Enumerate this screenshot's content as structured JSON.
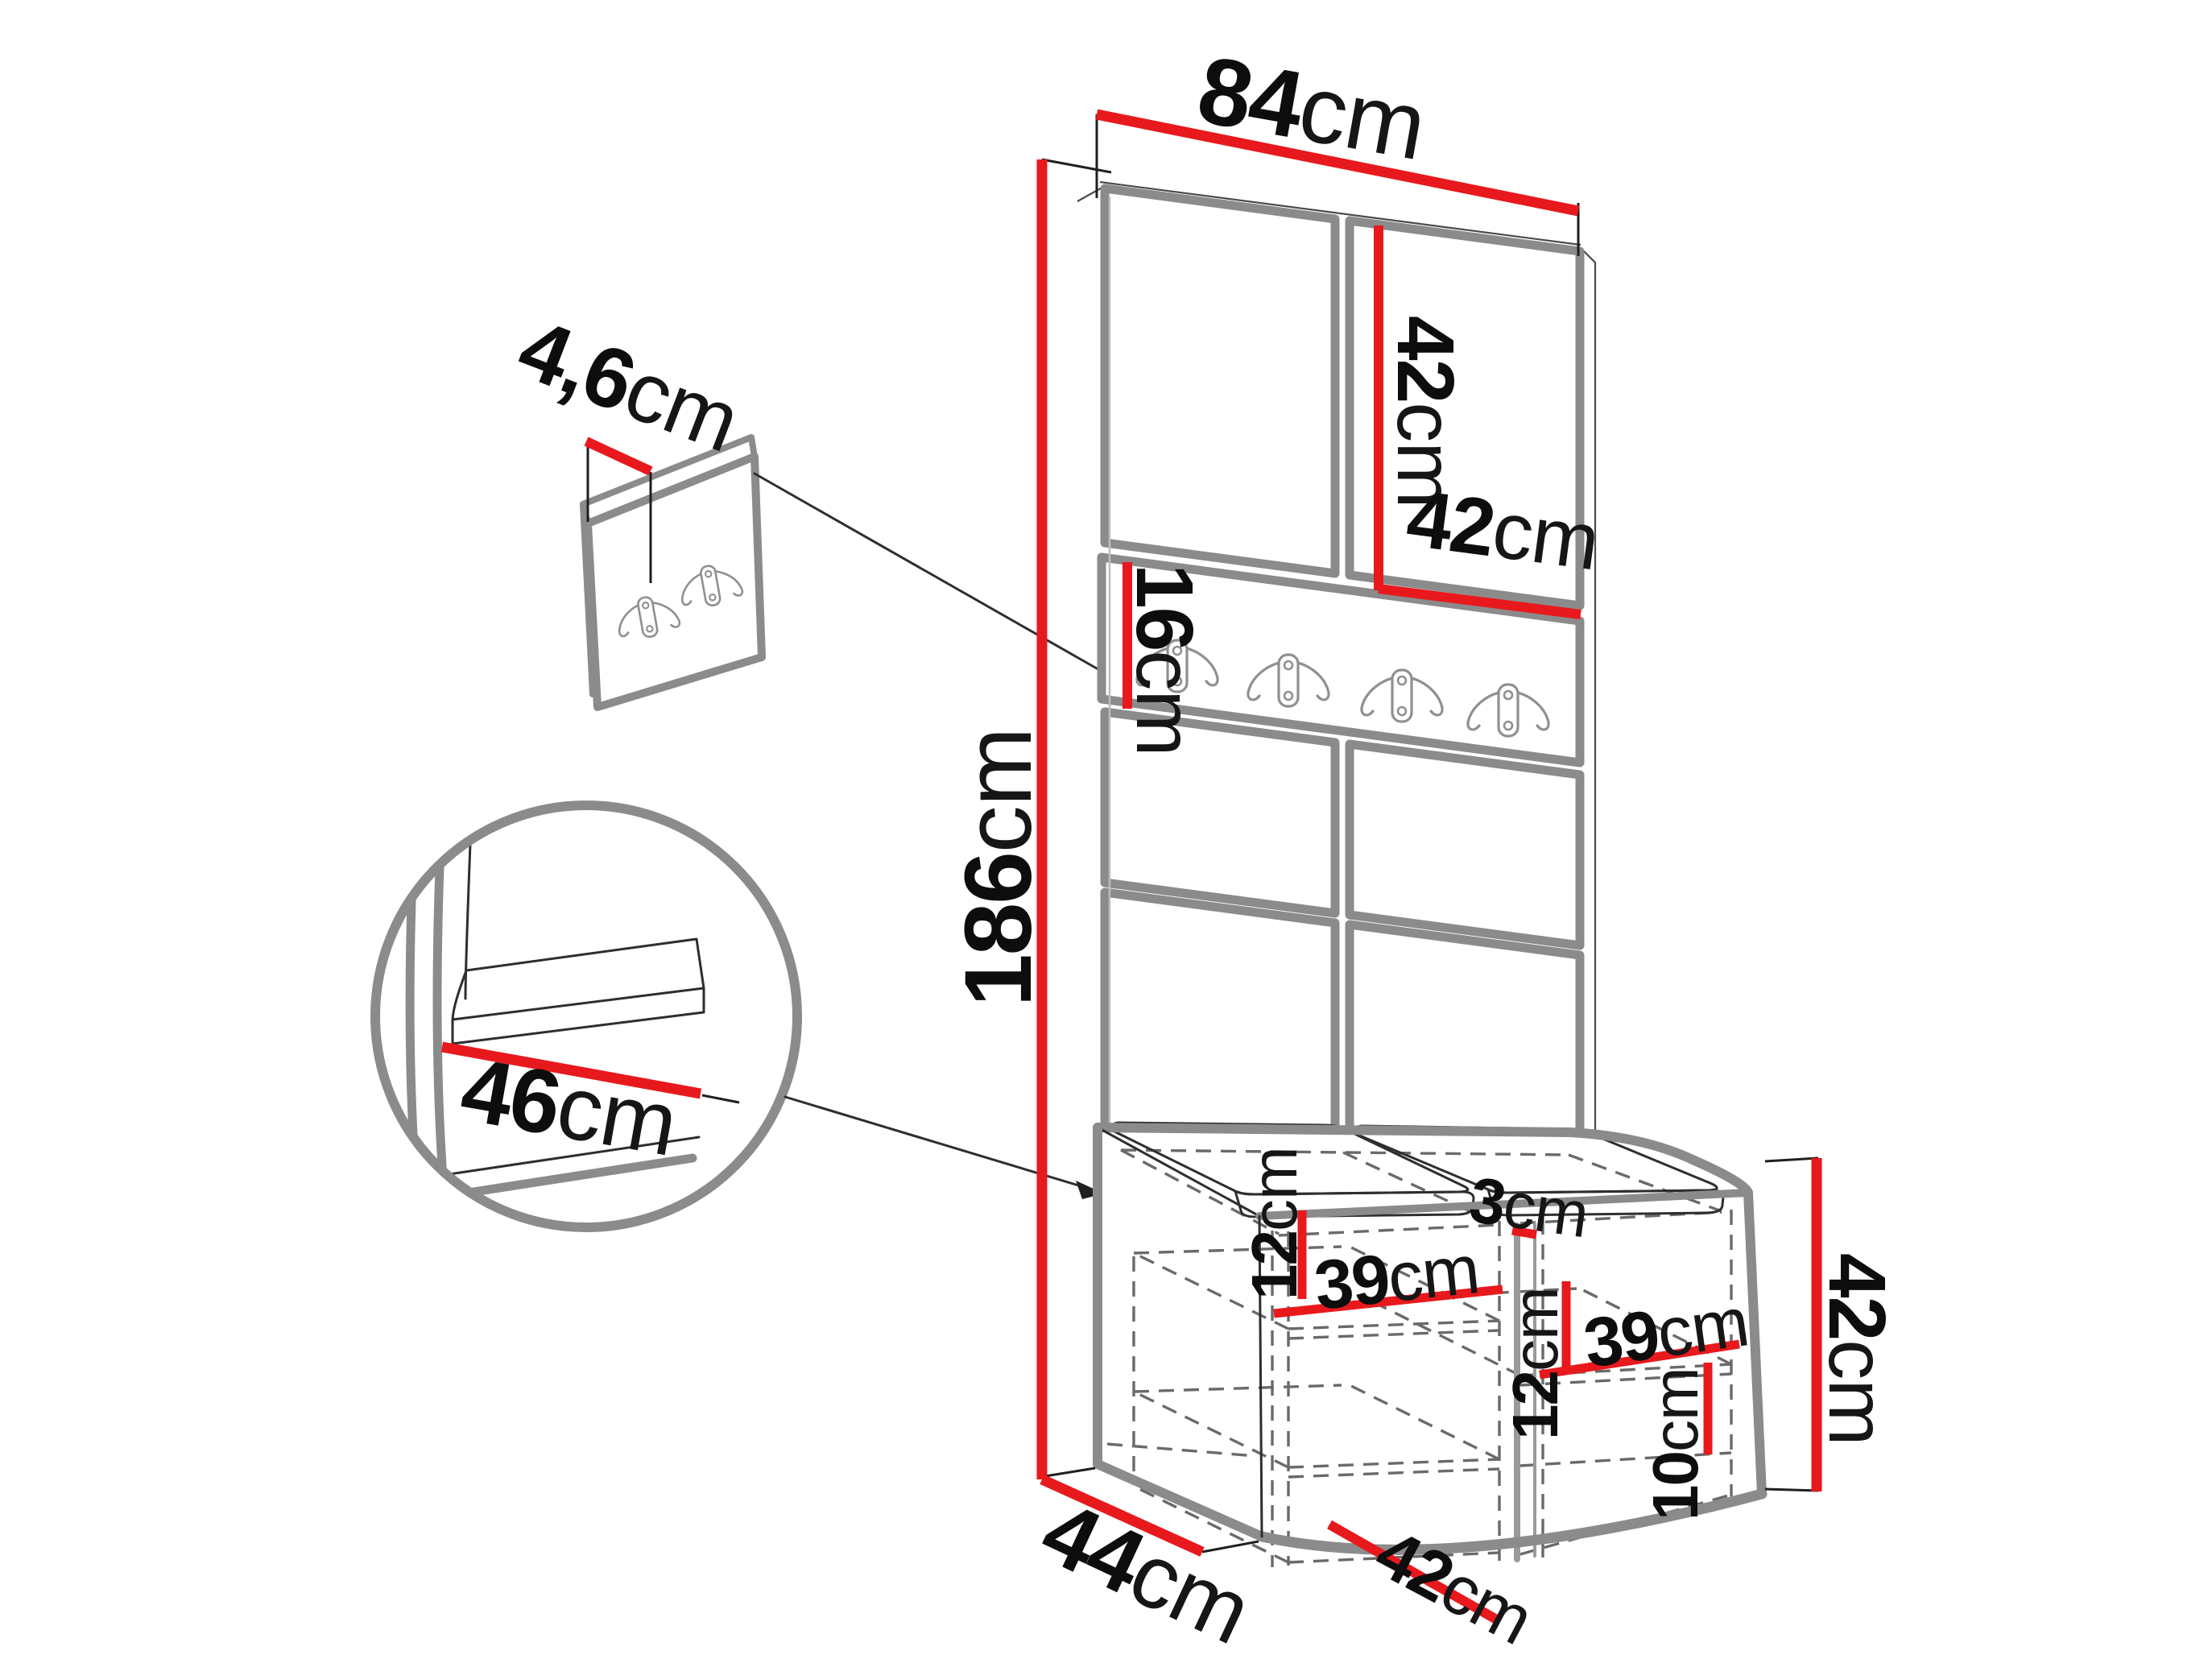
{
  "page": {
    "type": "furniture-dimension-diagram",
    "background": "#ffffff"
  },
  "colors": {
    "dimension_line": "#e8191d",
    "outline_gray": "#8b8b8b",
    "thin_line": "#2e2e2e",
    "hidden_edge_dash": "#6a6a6a",
    "text": "#0d0d0d"
  },
  "dimensions": {
    "top_width": {
      "num": "84",
      "unit": "cm"
    },
    "upper_panel_height": {
      "num": "42",
      "unit": "cm"
    },
    "upper_panel_width": {
      "num": "42",
      "unit": "cm"
    },
    "hook_rail_height": {
      "num": "16",
      "unit": "cm"
    },
    "total_height": {
      "num": "186",
      "unit": "cm"
    },
    "wall_panel_thickness": {
      "num": "4,6",
      "unit": "cm"
    },
    "seat_detail_width": {
      "num": "46",
      "unit": "cm"
    },
    "bench_depth": {
      "num": "44",
      "unit": "cm"
    },
    "left_shelf_spacing": {
      "num": "12",
      "unit": "cm"
    },
    "left_shelf_width": {
      "num": "39",
      "unit": "cm"
    },
    "divider_thickness": {
      "num": "3",
      "unit": "cm"
    },
    "right_shelf_spacing": {
      "num": "12",
      "unit": "cm"
    },
    "right_shelf_width": {
      "num": "39",
      "unit": "cm"
    },
    "bottom_shelf_height": {
      "num": "10",
      "unit": "cm"
    },
    "bench_inner_depth": {
      "num": "42",
      "unit": "cm"
    },
    "bench_height": {
      "num": "42",
      "unit": "cm"
    }
  },
  "features": {
    "rail_hook_count": 4,
    "wall_panel_hook_count": 2,
    "bench_compartments": 2,
    "seat_cushions": 2,
    "upper_panel_count": 2,
    "lower_panel_rows": 2
  }
}
